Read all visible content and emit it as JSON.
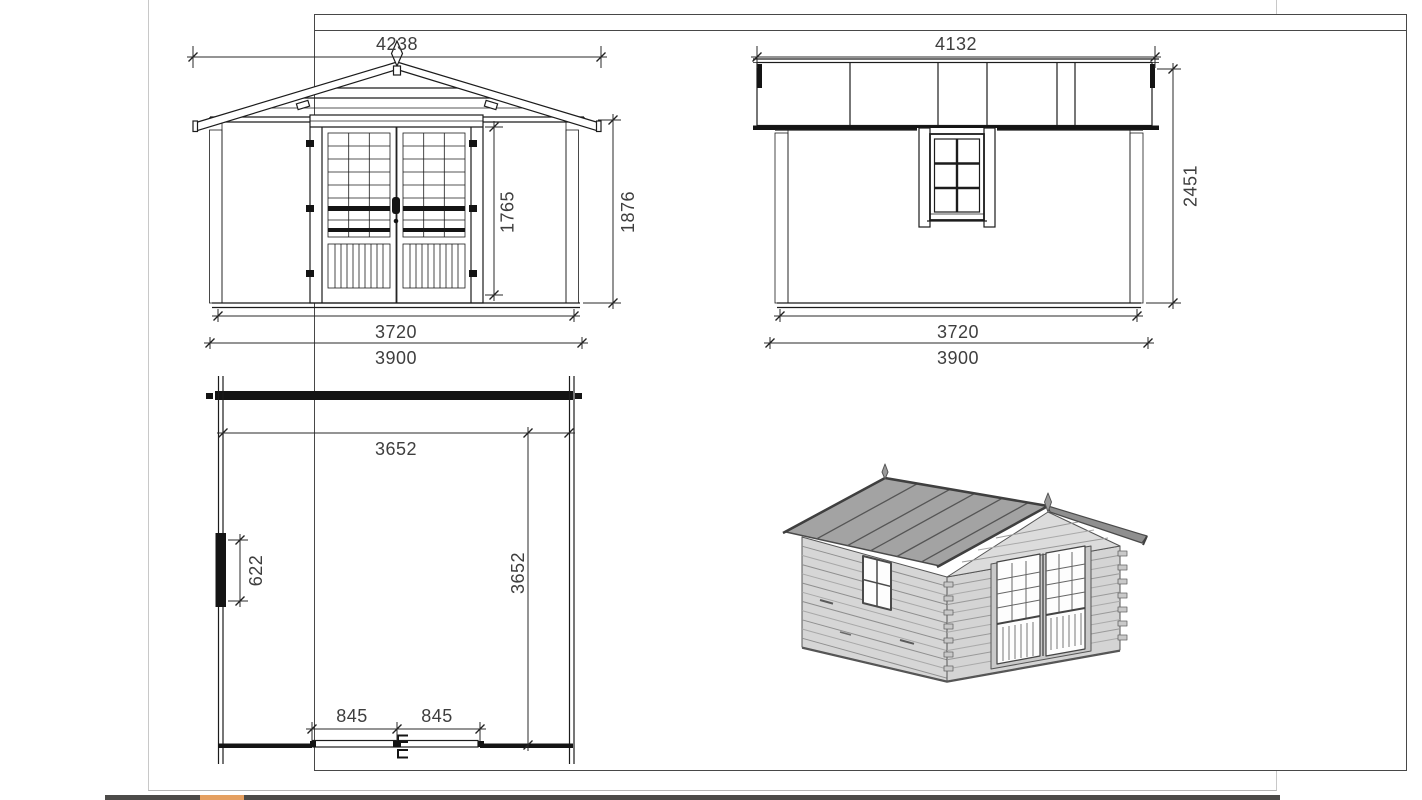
{
  "colors": {
    "paper": "#ffffff",
    "frame_border": "#474747",
    "ink": "#1c1c1c",
    "dimension_text": "#3e3e3e",
    "taskbar": "#4c4b49",
    "taskbar_accent": "#e5a061",
    "iso_roof_gray": "#a3a3a3",
    "iso_wall_gray": "#d6d6d6"
  },
  "views": {
    "front_elevation": {
      "dim_roof_width": "4238",
      "dim_door_height": "1765",
      "dim_eave_height": "1876",
      "dim_wall_width": "3720",
      "dim_base_width": "3900"
    },
    "side_elevation": {
      "dim_roof_length": "4132",
      "dim_total_height": "2451",
      "dim_wall_length": "3720",
      "dim_base_length": "3900"
    },
    "floor_plan": {
      "dim_inner_width": "3652",
      "dim_inner_depth": "3652",
      "dim_window_width": "622",
      "dim_door_leaf_left": "845",
      "dim_door_leaf_right": "845"
    }
  }
}
